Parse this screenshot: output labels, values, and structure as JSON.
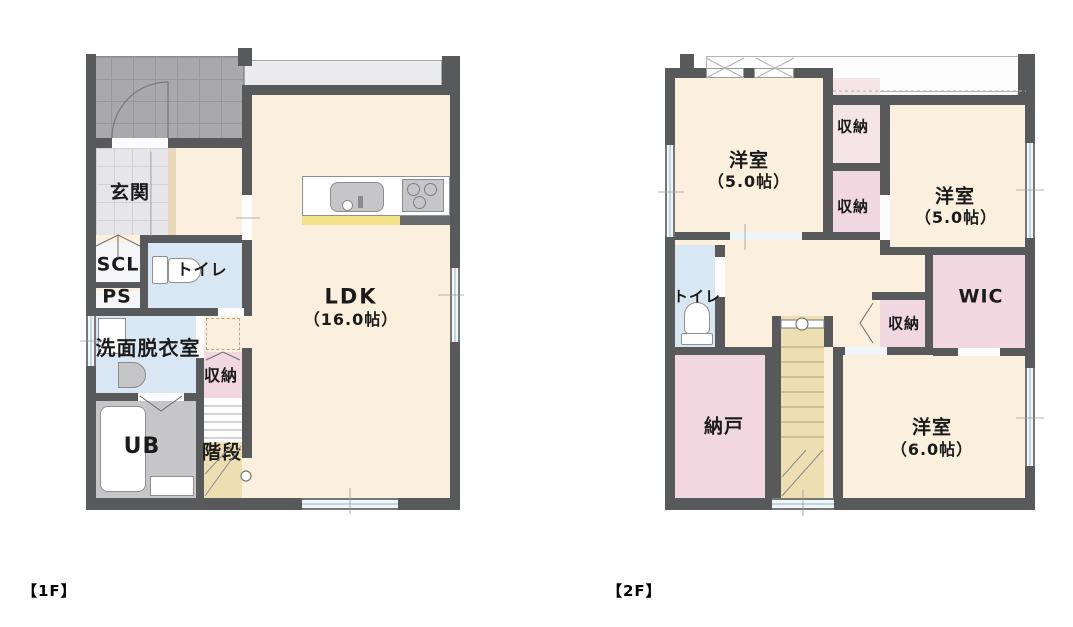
{
  "canvas": {
    "background": "#ffffff"
  },
  "palette": {
    "wall": "#58595b",
    "cream": "#faf0dd",
    "pink": "#f1d8e0",
    "pinklight": "#f5e4e8",
    "blue": "#d8e7f3",
    "ubgray": "#c6c6c8",
    "porchtile": "#a9a9ab",
    "genkantile": "#e6e6e8",
    "tan": "#eedfb2",
    "yellow": "#f2e08a",
    "winblue": "#eef6fa",
    "ink": "#1b1b1b"
  },
  "floor1": {
    "caption": "【1F】",
    "labels": {
      "genkan": "玄関",
      "scl": "SCL",
      "ps": "PS",
      "toilet": "トイレ",
      "senmen": "洗面脱衣室",
      "ub": "UB",
      "stairs": "階段",
      "closet": "収納",
      "ldk_name": "LDK",
      "ldk_size": "（16.0帖）"
    }
  },
  "floor2": {
    "caption": "【2F】",
    "labels": {
      "room_nw_name": "洋室",
      "room_nw_size": "（5.0帖）",
      "closet_a": "収納",
      "closet_b": "収納",
      "room_ne_name": "洋室",
      "room_ne_size": "（5.0帖）",
      "toilet": "トイレ",
      "wic": "WIC",
      "closet_c": "収納",
      "nando": "納戸",
      "room_s_name": "洋室",
      "room_s_size": "（6.0帖）"
    }
  }
}
